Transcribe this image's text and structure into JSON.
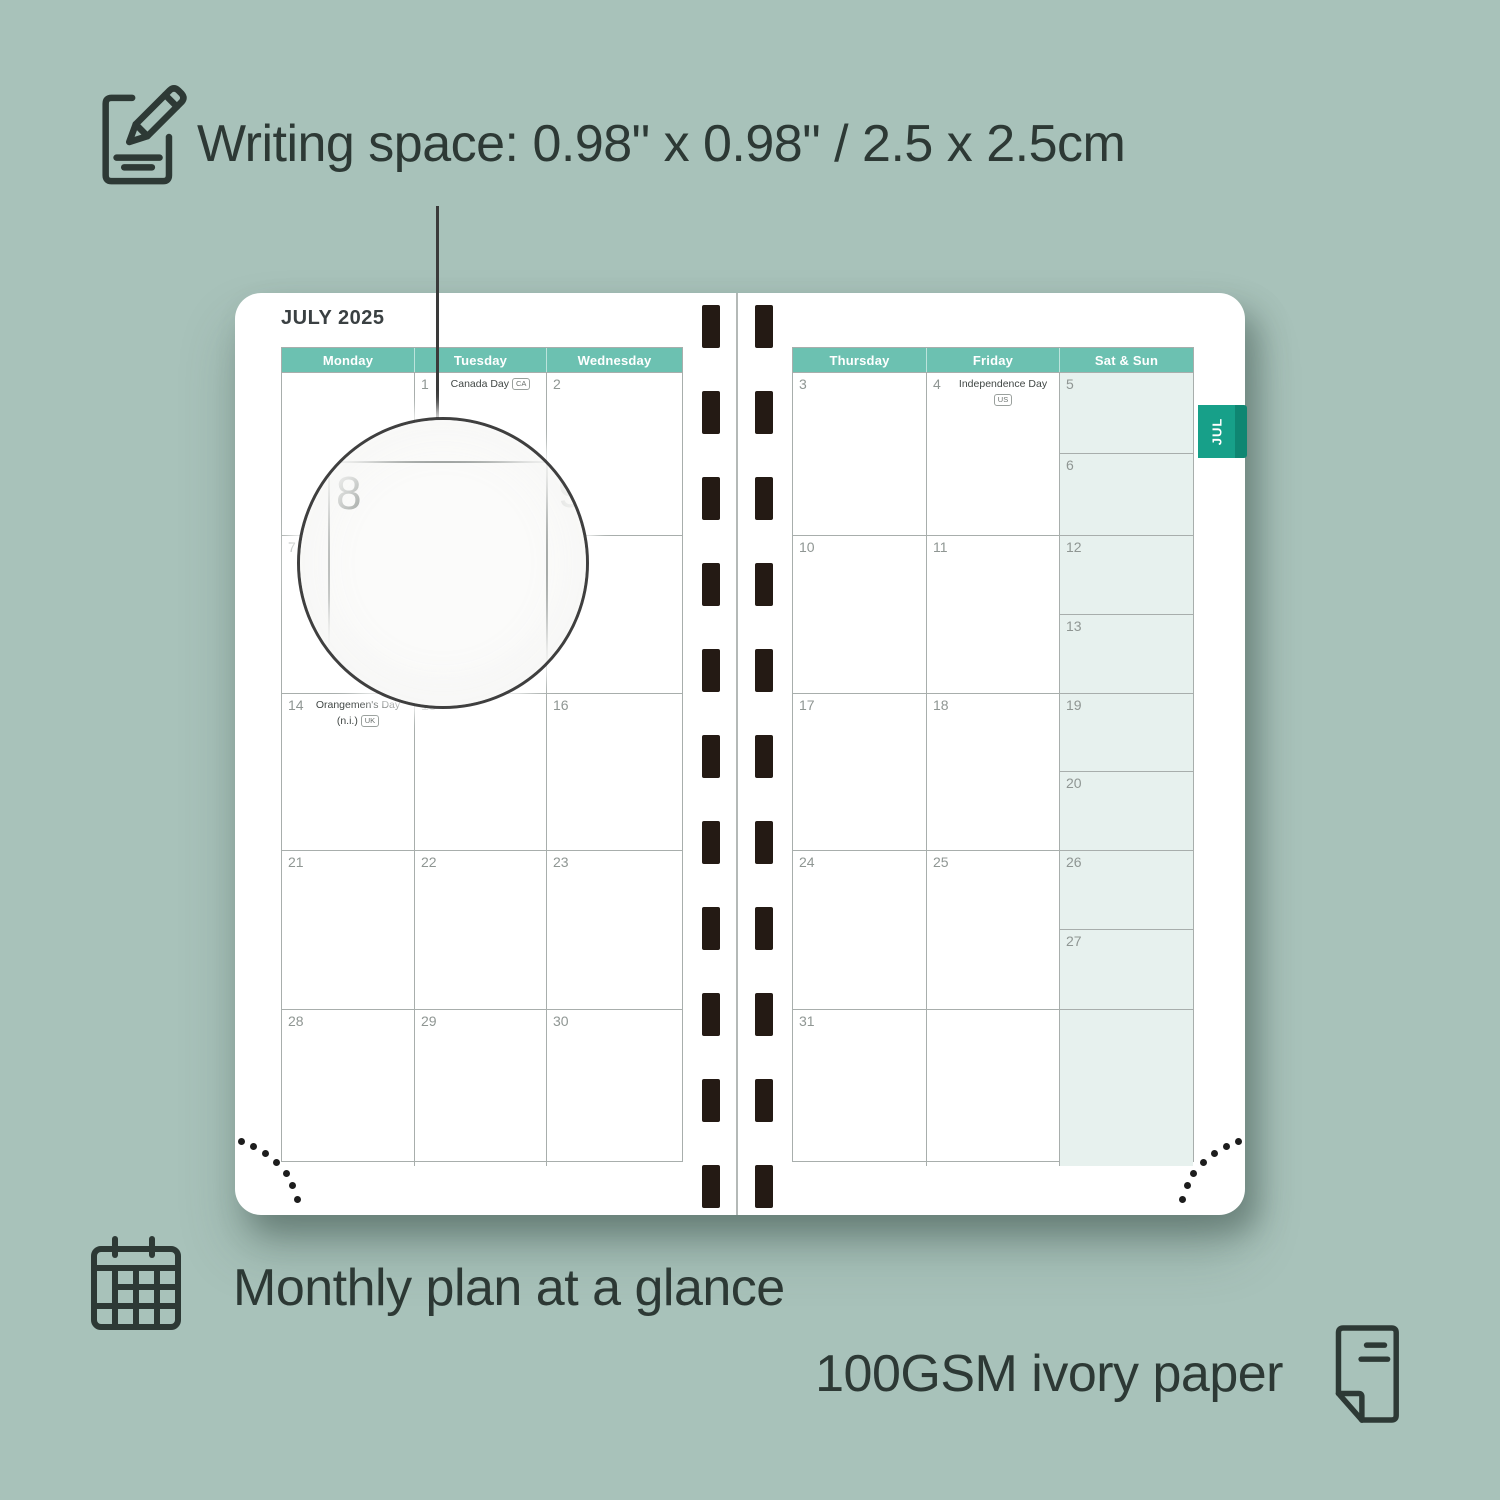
{
  "colors": {
    "background": "#a8c2ba",
    "text": "#2d3935",
    "header_teal": "#6cc1b1",
    "tab_teal": "#17a089",
    "weekend_tint": "#e7f1ee",
    "grid_line": "#a8aeac",
    "day_number_gray": "#8f9693",
    "spiral_hole": "#241a14"
  },
  "features": {
    "writing_space": {
      "icon": "notepad-pencil-icon",
      "label": "Writing space: 0.98\" x 0.98\" / 2.5 x 2.5cm"
    },
    "monthly_plan": {
      "icon": "calendar-grid-icon",
      "label": "Monthly plan at a glance"
    },
    "paper": {
      "icon": "paper-sheet-icon",
      "label": "100GSM ivory paper"
    }
  },
  "planner": {
    "title": "JULY 2025",
    "month_tab": "JUL",
    "left_page": {
      "headers": [
        "Monday",
        "Tuesday",
        "Wednesday"
      ],
      "rows": [
        [
          {
            "day": ""
          },
          {
            "day": "1",
            "holiday": "Canada Day",
            "badge": "CA"
          },
          {
            "day": "2"
          }
        ],
        [
          {
            "day": "7"
          },
          {
            "day": "8"
          },
          {
            "day": "9"
          }
        ],
        [
          {
            "day": "14",
            "holiday": "Orangemen's Day",
            "holiday_line2": "(n.i.)",
            "badge": "UK"
          },
          {
            "day": "15"
          },
          {
            "day": "16"
          }
        ],
        [
          {
            "day": "21"
          },
          {
            "day": "22"
          },
          {
            "day": "23"
          }
        ],
        [
          {
            "day": "28"
          },
          {
            "day": "29"
          },
          {
            "day": "30"
          }
        ]
      ]
    },
    "right_page": {
      "headers": [
        "Thursday",
        "Friday",
        "Sat & Sun"
      ],
      "rows": [
        [
          {
            "day": "3"
          },
          {
            "day": "4",
            "holiday": "Independence Day",
            "badge": "US"
          },
          {
            "weekend": [
              "5",
              "6"
            ]
          }
        ],
        [
          {
            "day": "10"
          },
          {
            "day": "11"
          },
          {
            "weekend": [
              "12",
              "13"
            ]
          }
        ],
        [
          {
            "day": "17"
          },
          {
            "day": "18"
          },
          {
            "weekend": [
              "19",
              "20"
            ]
          }
        ],
        [
          {
            "day": "24"
          },
          {
            "day": "25"
          },
          {
            "weekend": [
              "26",
              "27"
            ]
          }
        ],
        [
          {
            "day": "31"
          },
          {
            "day": ""
          },
          {
            "weekend": [
              ""
            ]
          }
        ]
      ]
    },
    "magnifier": {
      "zoom_day": "8",
      "zoom_adjacent_day": "9"
    }
  }
}
